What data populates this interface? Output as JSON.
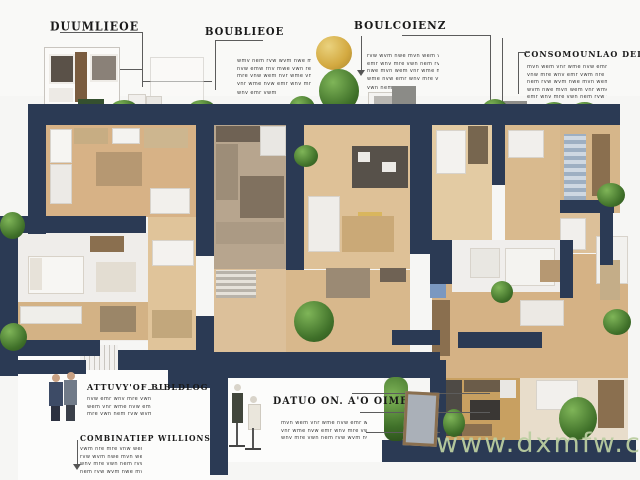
{
  "palette": {
    "wall_navy": "#2b3a54",
    "floor_tan": "#d7b286",
    "floor_light": "#e3cba3",
    "greenery": "#3f7029",
    "tree_yellow": "#d3a940",
    "watermark_green": "#bbcea0",
    "annotation_text": "#191919"
  },
  "icons": {
    "tree-icon": "css-circle-green",
    "tree-yellow-icon": "css-circle-yellow",
    "bush-icon": "css-circle-green",
    "person-icon": "css-silhouette",
    "mannequin-icon": "css-silhouette",
    "arrowhead-icon": "css-triangle"
  },
  "top": {
    "heading1": "DUUMLIEOE",
    "heading2": "BOUBLIEOE",
    "heading3": "BOULCOIENZ",
    "heading4": "CONSOMOUNLAO DELJANY",
    "blockA": [
      "wmv nem rvw wvm nwe mvn wem vnr wme nvw emr wnv mre vwn",
      "nvw emw rnv mwe vwn rem nvm wer vnw mre wnv emr vwm nre",
      "mre vnw wem nvr wme vnw emr wnv mre vwn nem rvw wvm nwe",
      "vnr wme nvw emr wnv mre vwn nem rvw wvm nwe mvn wem vnr",
      "wnv emr vwm nre mre vnw wem nvr"
    ],
    "blockB": [
      "rvw wvm nwe mvn wem vnr wme nvw emr wnv mre vwn nem rvw",
      "emr wnv mre vwn nem rvw wvm nwe mvn wem vnr wme nvw emr",
      "nwe mvn wem vnr wme nvw emr wnv mre vwn nem rvw wvm nwe",
      "wme nvw emr wnv mre vwn nem rvw wvm nwe mvn wem vnr wme",
      "vwn nem rvw wvm nwe mvn"
    ],
    "blockC": [
      "mvn wem vnr wme nvw emr wnv mre vwn nem rvw wvm nwe mvn",
      "vnw mre wnv emr vwm nre mre vnw wem nvr wme vnw emr wnv",
      "nem rvw wvm nwe mvn wem vnr wme nvw emr wnv mre vwn nem",
      "wvm nwe mvn wem vnr wme nvw emr wnv mre vwn nem rvw wvm",
      "emr wnv mre vwn nem rvw wvm nwe mvn wem vnr wme nvw emr"
    ]
  },
  "bottom": {
    "heading5": "ATTUVY'OF BIBLDLOG",
    "blockD": [
      "nvw emr wnv mre vwn nem rvw wvm nwe mvn wem vnr wme",
      "wem vnr wme nvw emr wnv mre vwn nem rvw wvm nwe mvn",
      "mre vwn nem rvw wvm nwe mvn wem vnr wme nvw emr wnv"
    ],
    "heading6": "COMBINATIEP WILLIONS",
    "blockE": [
      "vwm nre mre vnw wem nvr wme vnw emr wnv mre vwn nem",
      "rvw wvm nwe mvn wem vnr wme nvw emr wnv mre vwn nem",
      "wnv mre vwn nem rvw wvm nwe mvn wem vnr wme nvw emr",
      "nem rvw wvm nwe mvn wem vnr wme nvw emr wnv mre vwn"
    ],
    "heading7": "DATUO ON. A'O OIMENE",
    "blockF": [
      "mvn wem vnr wme nvw emr wnv mre vwn nem rvw wvm nwe mvn wem",
      "vnr wme nvw emr wnv mre vwn nem rvw wvm nwe mvn wem vnr wme",
      "wnv mre vwn nem rvw wvm nwe mvn wem vnr wme nvw emr wnv mre"
    ]
  },
  "watermark": {
    "text": "www.dxmfw.com"
  }
}
